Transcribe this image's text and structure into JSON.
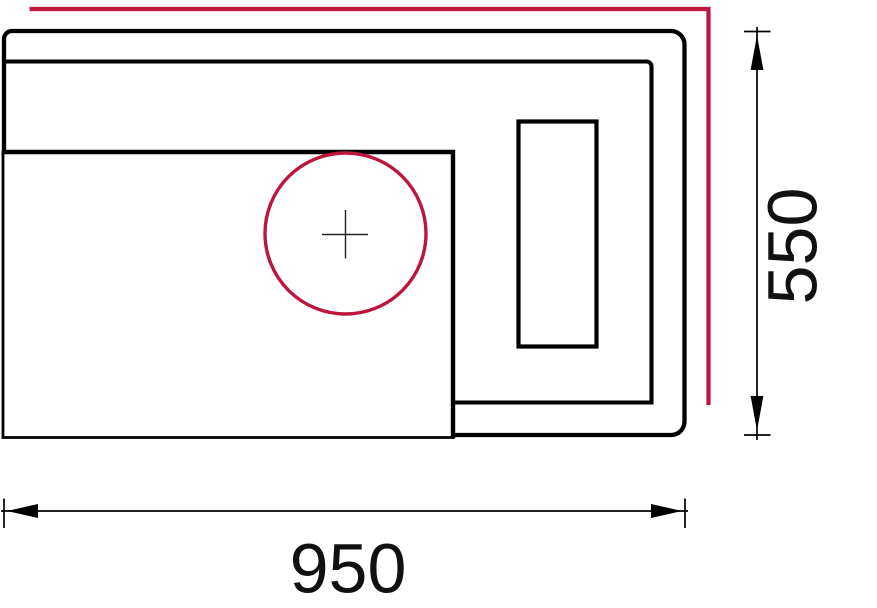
{
  "dimensions": {
    "width_label": "950",
    "height_label": "550"
  },
  "colors": {
    "outline": "#000000",
    "accent_red": "#bc163c",
    "center_mark": "#222222",
    "background": "#ffffff"
  }
}
